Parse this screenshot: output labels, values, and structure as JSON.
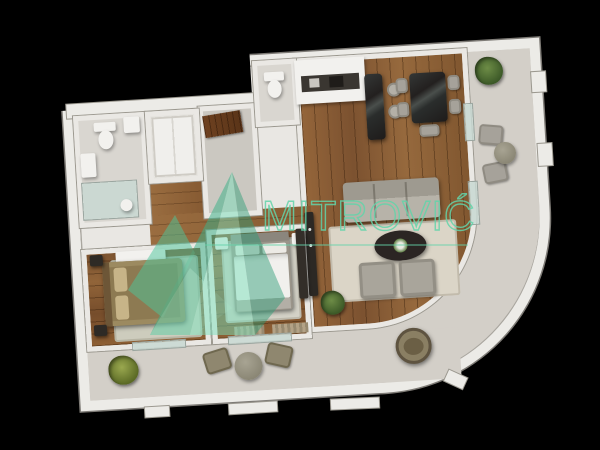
{
  "scene": {
    "type": "3d-apartment-floor-plan-render",
    "view": "top-down",
    "background_color": "#000000",
    "plan_tilt_deg": -3.5
  },
  "watermark": {
    "text": "MITROVIĆ",
    "color": "#63d4aa",
    "logo": "mountain-peaks-logo",
    "underline": true
  },
  "palette": {
    "outer_wall": "#ecebe7",
    "inner_wall": "#eae8e4",
    "wood_floor": "#8a5c34",
    "tile_floor": "#d9d6d0",
    "terrace_floor": "#d3cfc8",
    "sofa_gray": "#a9a59b",
    "marble_dark": "#2f3130",
    "bed_brown": "#8d7a52",
    "duvet_white": "#f1f0ed",
    "plant_green": "#54753a"
  },
  "floor_plan": {
    "rooms": [
      {
        "id": "bathroom",
        "furniture": [
          "toilet",
          "washing-machine",
          "vanity-sink",
          "glass-shower"
        ]
      },
      {
        "id": "entry-hall",
        "furniture": [
          "entry-wood-door",
          "built-in-closet",
          "wood-doormat"
        ]
      },
      {
        "id": "wc",
        "furniture": [
          "toilet"
        ]
      },
      {
        "id": "kitchen",
        "furniture": [
          "cabinet-run",
          "dark-counter",
          "sink",
          "cooktop",
          "marble-island",
          "bar-stool",
          "bar-stool"
        ]
      },
      {
        "id": "dining-area",
        "furniture": [
          "marble-dining-table",
          "dining-chair",
          "dining-chair",
          "dining-chair",
          "dining-chair",
          "dining-chair"
        ]
      },
      {
        "id": "living-room",
        "furniture": [
          "sofa",
          "area-rug",
          "oval-coffee-table",
          "armchair",
          "armchair",
          "tv-unit",
          "plant"
        ]
      },
      {
        "id": "bedroom-1",
        "furniture": [
          "double-bed-brown",
          "nightstand",
          "nightstand",
          "dresser",
          "rug"
        ]
      },
      {
        "id": "bedroom-2",
        "furniture": [
          "double-bed-white",
          "nightstand",
          "nightstand",
          "wardrobe",
          "rug",
          "doormat",
          "doormat"
        ]
      },
      {
        "id": "side-balcony",
        "furniture": [
          "plant",
          "balcony-chair",
          "balcony-chair",
          "round-table"
        ]
      },
      {
        "id": "curved-terrace",
        "furniture": [
          "hanging-egg-chair"
        ]
      },
      {
        "id": "bottom-terrace",
        "furniture": [
          "plant",
          "wicker-chair",
          "wicker-chair",
          "round-table"
        ]
      }
    ]
  }
}
